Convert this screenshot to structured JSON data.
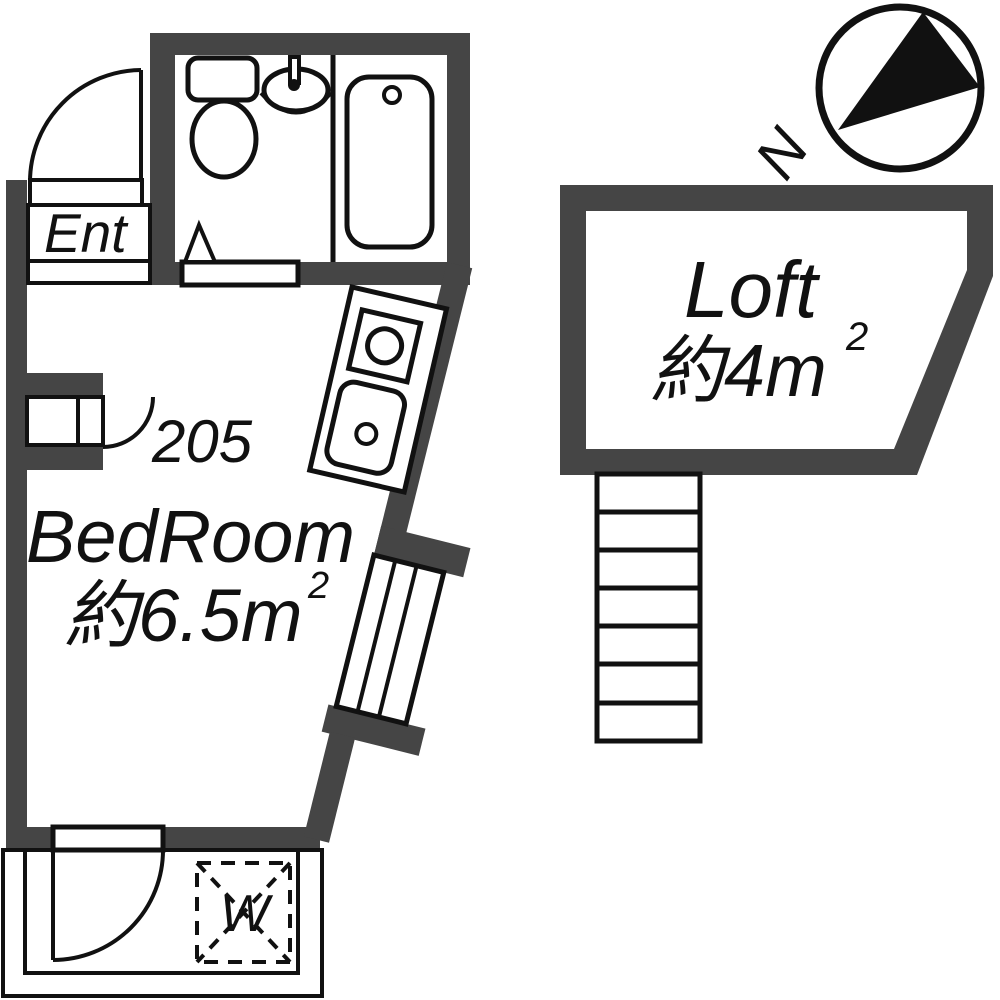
{
  "page": {
    "title": "Floor plan — Room 205"
  },
  "colors": {
    "wall": "#454545",
    "line": "#111111",
    "background": "#ffffff"
  },
  "labels": {
    "entrance": "Ent",
    "room_number": "205",
    "bedroom_name": "BedRoom",
    "bedroom_area": "約6.5m",
    "bedroom_area_sup": "2",
    "loft_name": "Loft",
    "loft_area": "約4m",
    "loft_area_sup": "2",
    "washer": "W",
    "north": "N"
  }
}
